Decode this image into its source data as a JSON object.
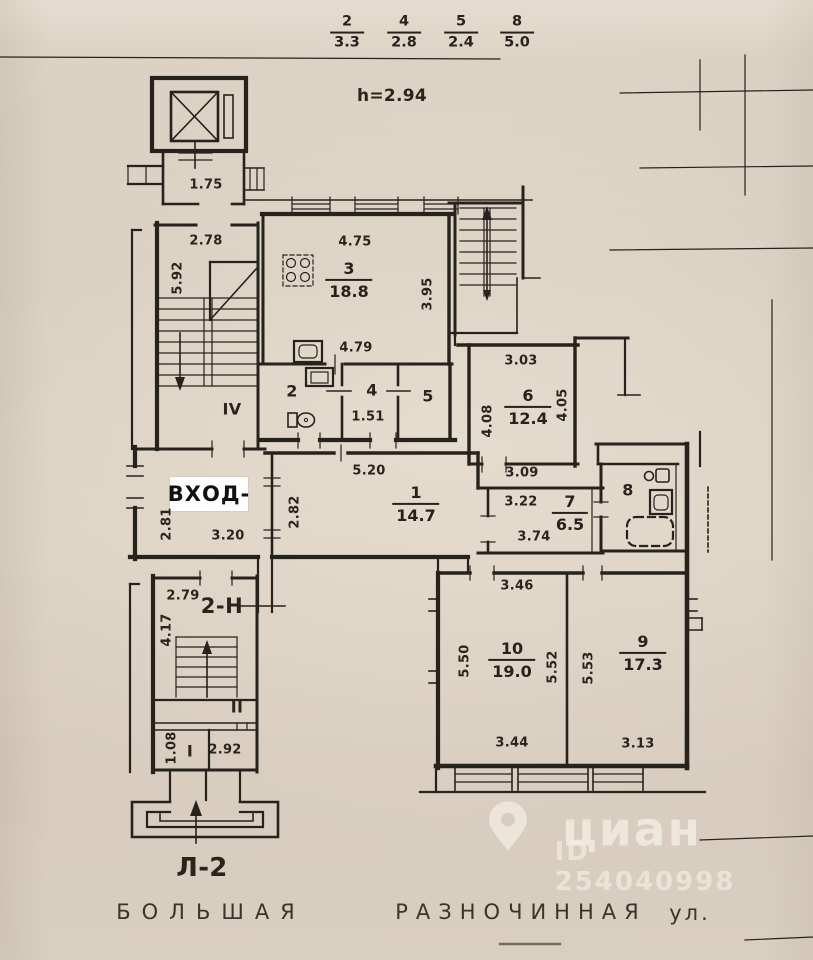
{
  "colors": {
    "paper": "#d8cec0",
    "ink": "#26221c",
    "sticker_bg": "#ffffff",
    "watermark": "rgba(244,238,227,0.75)"
  },
  "header": {
    "ceiling_height": "h=2.94",
    "fractions": [
      {
        "num": "2",
        "den": "3.3"
      },
      {
        "num": "4",
        "den": "2.8"
      },
      {
        "num": "5",
        "den": "2.4"
      },
      {
        "num": "8",
        "den": "5.0"
      }
    ]
  },
  "lift": {
    "lobby_dim": "1.75"
  },
  "stair_main": {
    "dim_top": "2.78",
    "dim_left": "5.92",
    "floor_mark": "IV"
  },
  "rooms": {
    "r1": {
      "num": "1",
      "area": "14.7",
      "dim_top": "5.20",
      "dim_left": "2.82"
    },
    "r2": {
      "num": "2"
    },
    "r3": {
      "num": "3",
      "area": "18.8",
      "dim_top": "4.75",
      "dim_right": "3.95",
      "dim_bottom": "4.79"
    },
    "r4": {
      "num": "4",
      "dim": "1.51"
    },
    "r5": {
      "num": "5"
    },
    "r6": {
      "num": "6",
      "area": "12.4",
      "dim_top": "3.03",
      "dim_left": "4.08",
      "dim_right": "4.05",
      "dim_bottom": "3.09"
    },
    "r7": {
      "num": "7",
      "area": "6.5",
      "dim_top": "3.22",
      "dim_bottom": "3.74"
    },
    "r8": {
      "num": "8"
    },
    "r9": {
      "num": "9",
      "area": "17.3",
      "dim_left": "5.53",
      "dim_bottom": "3.13"
    },
    "r10": {
      "num": "10",
      "area": "19.0",
      "dim_top": "3.46",
      "dim_left": "5.50",
      "dim_right": "5.52",
      "dim_bottom": "3.44"
    }
  },
  "entrance": {
    "label": "ВХОД-",
    "dim_left": "2.81",
    "dim_bottom": "3.20"
  },
  "stair_service": {
    "unit": "2-Н",
    "dim_top": "2.79",
    "dim_left": "4.17",
    "floor_mark_ii": "II",
    "floor_mark_i": "I",
    "dim_i_width": "2.92",
    "dim_i_depth": "1.08"
  },
  "porch": {
    "label": "Л-2"
  },
  "footer": {
    "street_part1": "БОЛЬШАЯ",
    "street_part2": "РАЗНОЧИННАЯ",
    "street_part3": "ул."
  },
  "watermark": {
    "brand": "циан",
    "listing_id": "ID 254040998"
  }
}
